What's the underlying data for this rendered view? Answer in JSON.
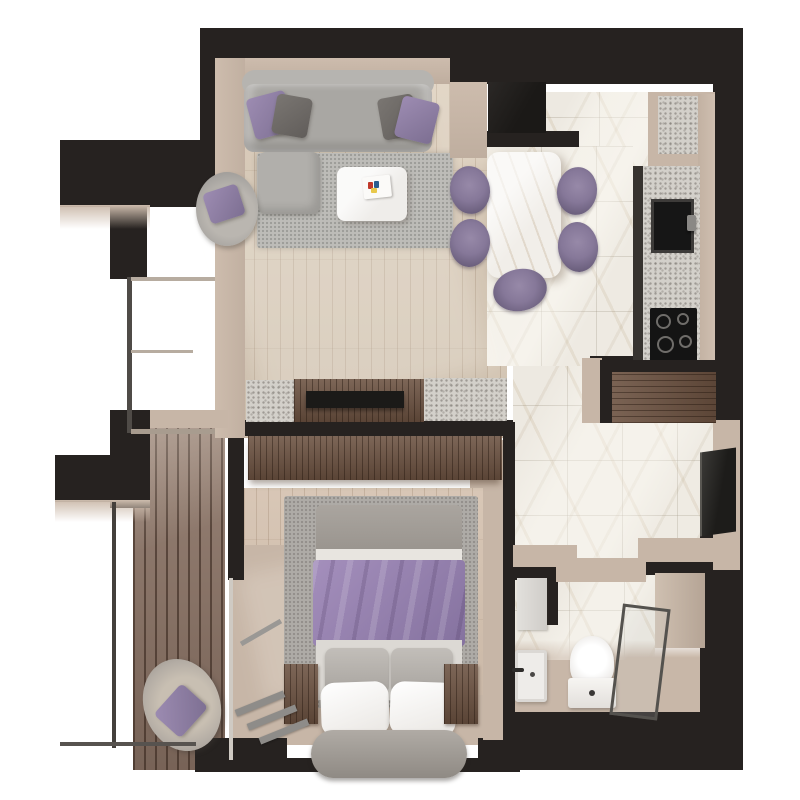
{
  "app": {
    "title": "3D Apartment Floor Plan — Top View",
    "type": "architectural-render",
    "visible_text": ""
  },
  "colors": {
    "wall": "#262220",
    "wallFace": "#c7b6a7",
    "woodLiving": "#d8c9b6",
    "woodBedroom": "#d5c2b0",
    "deck": "#8b7365",
    "marble": "#ede9e1",
    "granite": "#d3d0ca",
    "walnut": "#6b5140",
    "sofa": "#a9a7a3",
    "purple": "#8e7ca3",
    "rug": "#bdbcb8",
    "linen": "#f3f1ee",
    "tv": "#1b1a18"
  },
  "rooms": {
    "living_room": {
      "label": "Living room",
      "items": {
        "sofa": "Gray three-seat sofa with purple and charcoal cushions",
        "ottoman": "Square gray ottoman",
        "armchair": "Round gray armchair with purple cushion",
        "rug": "Gray area rug",
        "coffee_table": "White stone coffee table with books",
        "tv_console": "Walnut media console with flat-screen TV",
        "window": "Floor-to-ceiling corner window"
      }
    },
    "dining_kitchen": {
      "label": "Kitchen and dining area",
      "items": {
        "dining_table": "White marble dining table",
        "dining_chair": "Purple tub dining chair",
        "counter": "Granite kitchen counter",
        "sink": "Black undermount sink with faucet",
        "cooktop": "Four-burner black cooktop",
        "tall_cabinet": "Black tall kitchen cabinet",
        "appliance_niche": "Granite appliance niche"
      }
    },
    "hallway": {
      "label": "Hallway",
      "items": {
        "wardrobe": "Walnut entry wardrobe",
        "wall_panel": "Wall-mounted TV panel"
      }
    },
    "bedroom": {
      "label": "Bedroom",
      "items": {
        "bed": "Double bed with purple throw, gray duvet and white pillows",
        "headboard": "Upholstered gray headboard",
        "wardrobe": "Walnut built-in wardrobe",
        "nightstand_left": "Walnut nightstand (left)",
        "nightstand_right": "Walnut nightstand (right)",
        "rug": "Gray bedroom rug",
        "balcony_door": "Open balcony door with frame and treads"
      }
    },
    "bathroom": {
      "label": "Bathroom",
      "items": {
        "toilet": "Toilet",
        "sink": "Wall-hung washbasin",
        "shower": "Glass shower enclosure",
        "door": "Bathroom door panel"
      }
    },
    "balcony": {
      "label": "Balcony",
      "items": {
        "deck": "Dark timber decking",
        "lounge_chair": "Gray lounge chair with purple cushion",
        "railing": "Glass railing"
      }
    }
  }
}
